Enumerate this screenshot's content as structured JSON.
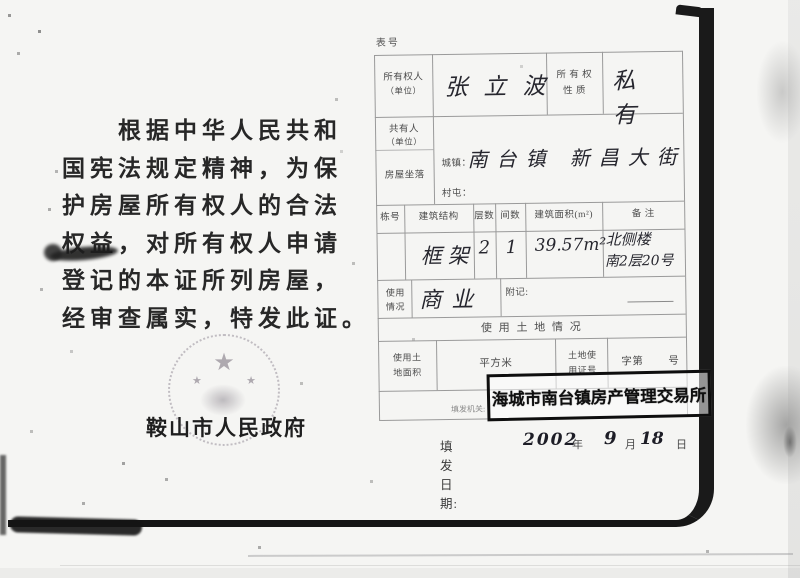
{
  "colors": {
    "paper": "#f5f5f3",
    "ink": "#222222",
    "stamp_ink": "#111111",
    "table_line": "#999999",
    "seal_gray": "#8a8290"
  },
  "left_page": {
    "paragraph_lines": [
      "根据中华人民共和",
      "国宪法规定精神，为保",
      "护房屋所有权人的合法",
      "权益，对所有权人申请",
      "登记的本证所列房屋，",
      "经审查属实，特发此证。"
    ],
    "seal": {
      "icon": "national-emblem-star",
      "star_glyph": "★"
    },
    "issuer": "鞍山市人民政府"
  },
  "form": {
    "doc_no_label": "表号",
    "owner": {
      "label_line1": "所有权人",
      "label_line2": "（单位）",
      "value": "张立波"
    },
    "ownership": {
      "label_line1": "所 有 权",
      "label_line2": "性    质",
      "value": "私有"
    },
    "co_owner": {
      "label_line1": "共有人",
      "label_line2": "（单位）",
      "value": ""
    },
    "location": {
      "label": "房屋坐落",
      "town_label": "城镇：",
      "town_value": "南台镇 新昌大街",
      "village_label": "村屯：",
      "village_value": ""
    },
    "building_table": {
      "headers": [
        "栋号",
        "建筑结构",
        "层数",
        "间数",
        "建筑面积(m²)",
        "备  注"
      ],
      "row": {
        "building_no": "",
        "structure": "框架",
        "floors": "2",
        "rooms": "1",
        "area": "39.57m²",
        "remark_line1": "北侧楼",
        "remark_line2": "南2层20号"
      }
    },
    "usage": {
      "label_line1": "使用",
      "label_line2": "情况",
      "value": "商业"
    },
    "appendix_label": "附记:",
    "land_section": {
      "title": "使 用 土 地 情 况",
      "area_label_line1": "使用土",
      "area_label_line2": "地面积",
      "area_unit": "平方米",
      "area_value": "",
      "cert_label_line1": "土地使",
      "cert_label_line2": "用证号",
      "cert_prefix": "字第",
      "cert_suffix": "号",
      "cert_value": ""
    },
    "issuing_org_label": "填发机关:",
    "stamp_text": "海城市南台镇房产管理交易所",
    "issue_date": {
      "label": "填发日期:",
      "year": "2002",
      "year_unit": "年",
      "month": "9",
      "month_unit": "月",
      "day": "18",
      "day_unit": "日"
    }
  }
}
